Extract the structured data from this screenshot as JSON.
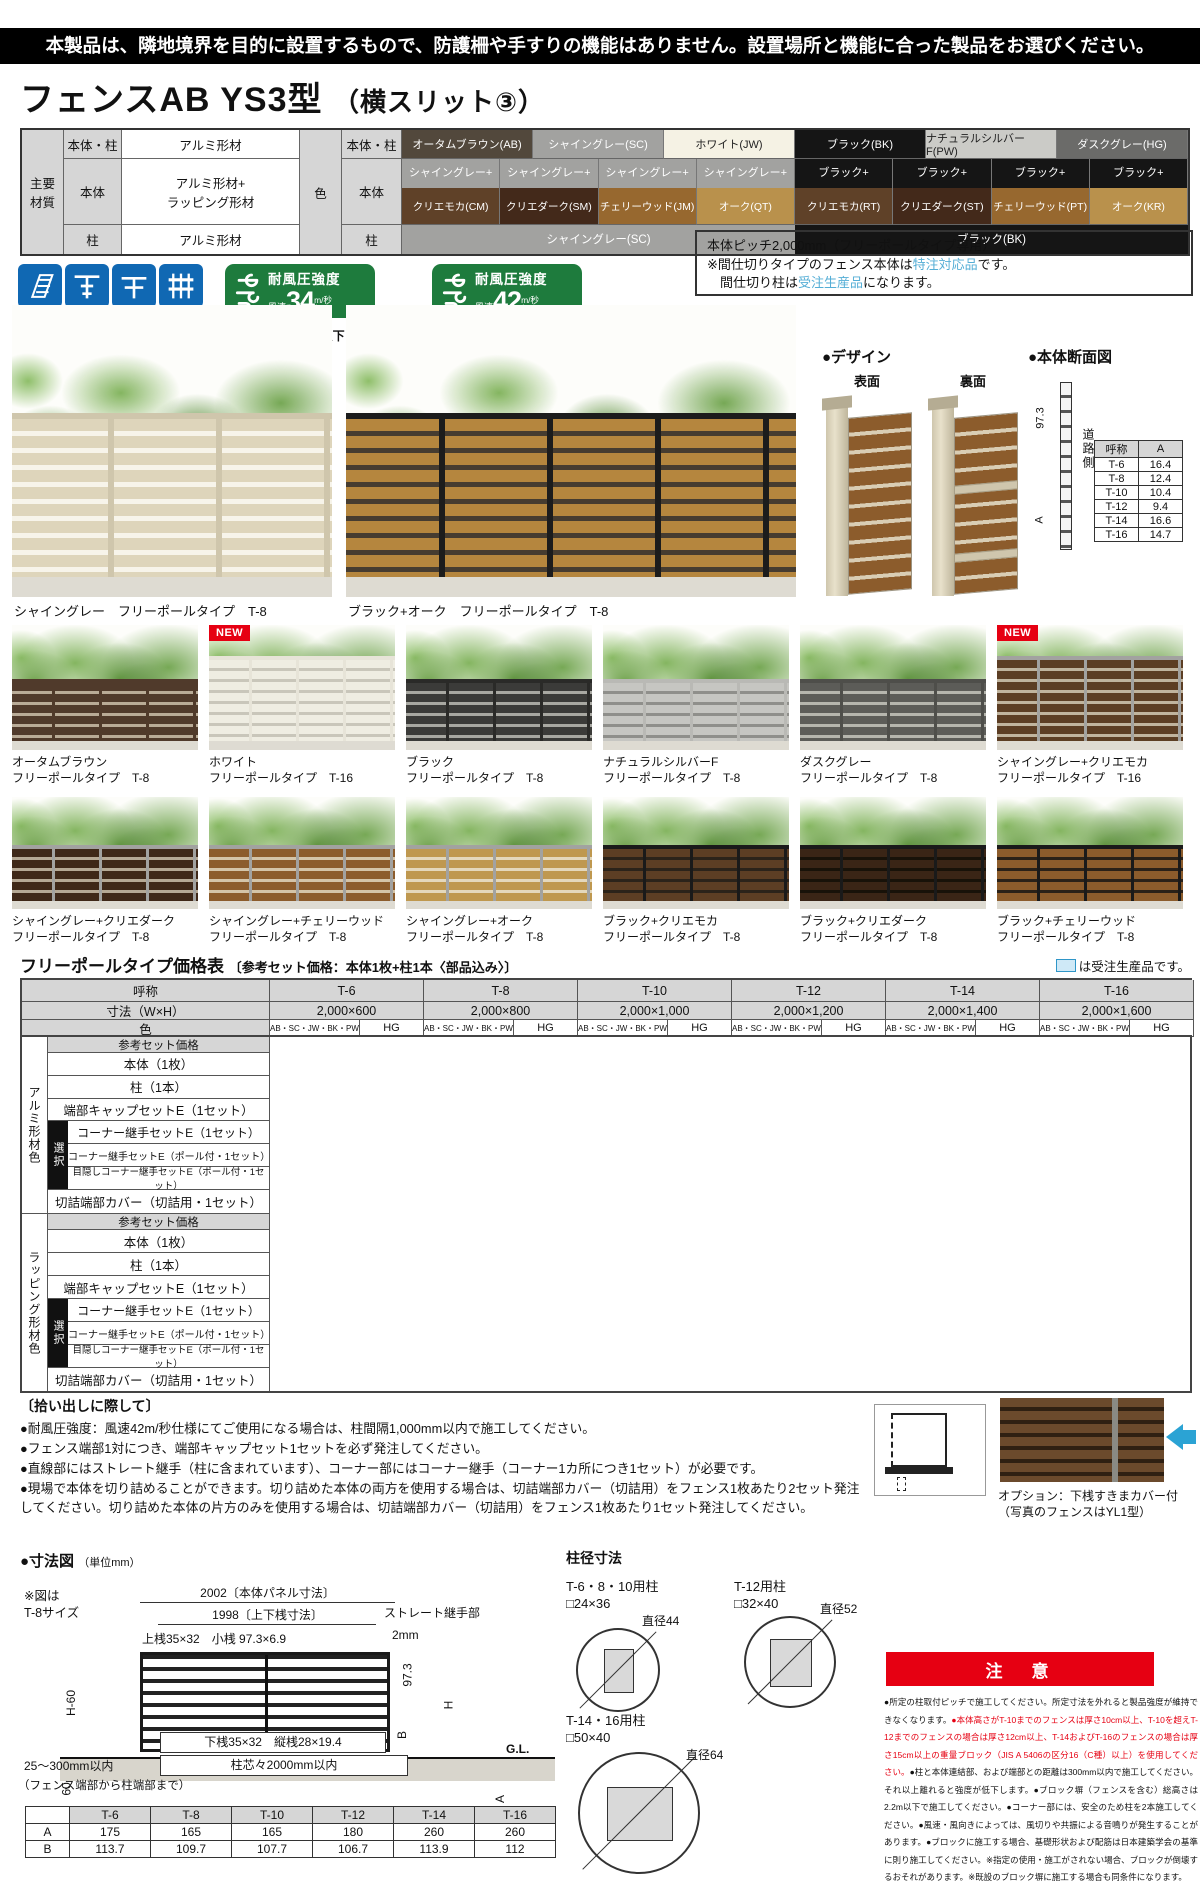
{
  "page": {
    "top_banner": "本製品は、隣地境界を目的に設置するもので、防護柵や手すりの機能はありません。設置場所と機能に合った製品をお選びください。",
    "title_main": "フェンスAB YS3型",
    "title_sub": "（横スリット③）",
    "new_badge": "NEW"
  },
  "materials": {
    "header_main": "主要\n材質",
    "header_color": "色",
    "rows": [
      {
        "part": "本体・柱",
        "material": "アルミ形材"
      },
      {
        "part": "本体",
        "material": "アルミ形材+\nラッピング形材"
      },
      {
        "part": "柱",
        "material": "アルミ形材"
      }
    ],
    "color_parts": [
      "本体・柱",
      "本体",
      "柱"
    ],
    "colors_row1": [
      {
        "label": "オータムブラウン(AB)",
        "bg": "#52483c",
        "fg": "#ffffff"
      },
      {
        "label": "シャイングレー(SC)",
        "bg": "#a2a2a0",
        "fg": "#ffffff"
      },
      {
        "label": "ホワイト(JW)",
        "bg": "#f5f2e4",
        "fg": "#222222"
      },
      {
        "label": "ブラック(BK)",
        "bg": "#151515",
        "fg": "#ffffff"
      },
      {
        "label": "ナチュラルシルバーF(PW)",
        "bg": "#cbcbc7",
        "fg": "#222222"
      },
      {
        "label": "ダスクグレー(HG)",
        "bg": "#6b6b69",
        "fg": "#ffffff"
      }
    ],
    "colors_row2": [
      {
        "top": "シャイングレー+",
        "top_bg": "#a2a2a0",
        "label": "クリエモカ(CM)",
        "bg": "#5f4128"
      },
      {
        "top": "シャイングレー+",
        "top_bg": "#a2a2a0",
        "label": "クリエダーク(SM)",
        "bg": "#43291a"
      },
      {
        "top": "シャイングレー+",
        "top_bg": "#a2a2a0",
        "label": "チェリーウッド(JM)",
        "bg": "#97682f"
      },
      {
        "top": "シャイングレー+",
        "top_bg": "#a2a2a0",
        "label": "オーク(QT)",
        "bg": "#b9914c"
      },
      {
        "top": "ブラック+",
        "top_bg": "#151515",
        "label": "クリエモカ(RT)",
        "bg": "#5f4128"
      },
      {
        "top": "ブラック+",
        "top_bg": "#151515",
        "label": "クリエダーク(ST)",
        "bg": "#43291a"
      },
      {
        "top": "ブラック+",
        "top_bg": "#151515",
        "label": "チェリーウッド(PT)",
        "bg": "#97682f"
      },
      {
        "top": "ブラック+",
        "top_bg": "#151515",
        "label": "オーク(KR)",
        "bg": "#b9914c"
      }
    ],
    "colors_row3": [
      {
        "label": "シャイングレー(SC)",
        "bg": "#a2a2a0",
        "fg": "#ffffff"
      },
      {
        "label": "ブラック(BK)",
        "bg": "#151515",
        "fg": "#ffffff"
      }
    ]
  },
  "features": {
    "icons": [
      {
        "label": "片面模様"
      },
      {
        "label": "フリーポール\n（自在柱）"
      },
      {
        "label": "間仕切り※\n（間柱）"
      },
      {
        "label": "多段取付\n可能"
      }
    ],
    "badges": [
      {
        "title": "耐風圧強度",
        "prefix": "風速",
        "value": "34",
        "unit": "m/秒",
        "suffix": "相当",
        "note": "柱ピッチ2m以下"
      },
      {
        "title": "耐風圧強度",
        "prefix": "風速",
        "value": "42",
        "unit": "m/秒",
        "suffix": "相当",
        "note": "柱ピッチ1m以下"
      }
    ],
    "info_box": {
      "line1": "本体ピッチ2,000mm（フリーポールタイプ専用）",
      "line2_pre": "※間仕切りタイプのフェンス本体は",
      "line2_hl": "特注対応品",
      "line2_post": "です。",
      "line3_pre": "　間仕切り柱は",
      "line3_hl": "受注生産品",
      "line3_post": "になります。"
    }
  },
  "hero": [
    {
      "caption": "シャイングレー　フリーポールタイプ　T-8",
      "slat": "#ded5bb",
      "gap": "#f7f4ea",
      "post": "#cfc6ac",
      "new": false,
      "tall": false
    },
    {
      "caption": "ブラック+オーク　フリーポールタイプ　T-8",
      "slat": "#b5863e",
      "gap": "#463c30",
      "post": "#1c1c1c",
      "new": false,
      "tall": false
    }
  ],
  "design": {
    "heading": "●デザイン",
    "front": "表面",
    "back": "裏面"
  },
  "cross_section": {
    "heading": "●本体断面図",
    "dim": "97.3",
    "dim2": "A",
    "road": "道路側",
    "table_headers": [
      "呼称",
      "A"
    ],
    "table_rows": [
      [
        "T-6",
        "16.4"
      ],
      [
        "T-8",
        "12.4"
      ],
      [
        "T-10",
        "10.4"
      ],
      [
        "T-12",
        "9.4"
      ],
      [
        "T-14",
        "16.6"
      ],
      [
        "T-16",
        "14.7"
      ]
    ]
  },
  "gallery": [
    {
      "name": "オータムブラウン",
      "type": "フリーポールタイプ　T-8",
      "new": false,
      "tall": false,
      "slat": "#503a2b",
      "gap": "#b9ab97",
      "post": "#503a2b"
    },
    {
      "name": "ホワイト",
      "type": "フリーポールタイプ　T-16",
      "new": true,
      "tall": true,
      "slat": "#efede2",
      "gap": "#c9c6ba",
      "post": "#e7e4d8"
    },
    {
      "name": "ブラック",
      "type": "フリーポールタイプ　T-8",
      "new": false,
      "tall": false,
      "slat": "#3b3b39",
      "gap": "#a8a8a2",
      "post": "#2a2a28"
    },
    {
      "name": "ナチュラルシルバーF",
      "type": "フリーポールタイプ　T-8",
      "new": false,
      "tall": false,
      "slat": "#c6c6c2",
      "gap": "#8f8f8b",
      "post": "#b9b9b5"
    },
    {
      "name": "ダスクグレー",
      "type": "フリーポールタイプ　T-8",
      "new": false,
      "tall": false,
      "slat": "#5c5c58",
      "gap": "#b5b5ad",
      "post": "#4e4e4a"
    },
    {
      "name": "シャイングレー+クリエモカ",
      "type": "フリーポールタイプ　T-16",
      "new": true,
      "tall": true,
      "slat": "#5c3e24",
      "gap": "#c0b49e",
      "post": "#a2a2a0"
    },
    {
      "name": "シャイングレー+クリエダーク",
      "type": "フリーポールタイプ　T-8",
      "new": false,
      "tall": false,
      "slat": "#3f2818",
      "gap": "#b5a894",
      "post": "#a2a2a0"
    },
    {
      "name": "シャイングレー+チェリーウッド",
      "type": "フリーポールタイプ　T-8",
      "new": false,
      "tall": false,
      "slat": "#8c5c2c",
      "gap": "#d4c4a8",
      "post": "#a2a2a0"
    },
    {
      "name": "シャイングレー+オーク",
      "type": "フリーポールタイプ　T-8",
      "new": false,
      "tall": false,
      "slat": "#bf984f",
      "gap": "#e4d8bc",
      "post": "#a2a2a0"
    },
    {
      "name": "ブラック+クリエモカ",
      "type": "フリーポールタイプ　T-8",
      "new": false,
      "tall": false,
      "slat": "#5c3e24",
      "gap": "#2b231a",
      "post": "#1a1a1a"
    },
    {
      "name": "ブラック+クリエダーク",
      "type": "フリーポールタイプ　T-8",
      "new": false,
      "tall": false,
      "slat": "#3a2516",
      "gap": "#181209",
      "post": "#1a1a1a"
    },
    {
      "name": "ブラック+チェリーウッド",
      "type": "フリーポールタイプ　T-8",
      "new": false,
      "tall": false,
      "slat": "#8c5c2c",
      "gap": "#2a2118",
      "post": "#1a1a1a"
    }
  ],
  "price_table": {
    "title": "フリーポールタイプ価格表",
    "subtitle": "〔参考セット価格：本体1枚+柱1本〈部品込み〉〕",
    "legend": "は受注生産品です。",
    "name_header": "呼称",
    "columns": [
      "T-6",
      "T-8",
      "T-10",
      "T-12",
      "T-14",
      "T-16"
    ],
    "size_header": "寸法（W×H）",
    "sizes": [
      "2,000×600",
      "2,000×800",
      "2,000×1,000",
      "2,000×1,200",
      "2,000×1,400",
      "2,000×1,600"
    ],
    "color_header": "色",
    "color_groups": [
      "AB・SC・JW・BK・PW",
      "HG"
    ],
    "select_label": "選択",
    "groups": [
      {
        "name": "アルミ形材色"
      },
      {
        "name": "ラッピング形材色"
      }
    ],
    "row_labels": {
      "set": "参考セット価格",
      "rows1": [
        "本体（1枚）",
        "柱（1本）",
        "端部キャップセットE（1セット）"
      ],
      "select_rows": [
        "コーナー継手セットE（1セット）",
        "コーナー継手セットE（ポール付・1セット）",
        "目隠しコーナー継手セットE（ポール付・1セット）"
      ],
      "rows2": [
        "切詰端部カバー（切詰用・1セット）"
      ]
    }
  },
  "notes": {
    "heading": "〔拾い出しに際して〕",
    "items": [
      "●耐風圧強度：風速42m/秒仕様にてご使用になる場合は、柱間隔1,000mm以内で施工してください。",
      "●フェンス端部1対につき、端部キャップセット1セットを必ず発注してください。",
      "●直線部にはストレート継手（柱に含まれています）、コーナー部にはコーナー継手（コーナー1カ所につき1セット）が必要です。",
      "●現場で本体を切り詰めることができます。切り詰めた本体の両方を使用する場合は、切詰端部カバー（切詰用）をフェンス1枚あたり2セット発注してください。切り詰めた本体の片方のみを使用する場合は、切詰端部カバー（切詰用）をフェンス1枚あたり1セット発注してください。"
    ],
    "option_caption1": "オプション：下桟すきまカバー付",
    "option_caption2": "（写真のフェンスはYL1型）"
  },
  "dimensions": {
    "heading": "●寸法図",
    "unit": "（単位mm）",
    "fig_note": "※図は\nT-8サイズ",
    "panel_width": "2002〔本体パネル寸法〕",
    "rail_width": "1998〔上下桟寸法〕",
    "joint_label": "ストレート継手部",
    "joint_size": "2mm",
    "top_rail": "上桟35×32　小桟 97.3×6.9",
    "h60": "H-60",
    "v973": "97.3",
    "h": "H",
    "b": "B",
    "gl": "G.L.",
    "v60": "60",
    "a": "A",
    "bottom_rail": "下桟35×32　縦桟28×19.4",
    "pitch": "柱芯々2000mm以内",
    "end_range": "25～300mm以内",
    "end_note": "（フェンス端部から柱端部まで）",
    "ab_table": {
      "cols": [
        "T-6",
        "T-8",
        "T-10",
        "T-12",
        "T-14",
        "T-16"
      ],
      "rows": [
        {
          "label": "A",
          "values": [
            "175",
            "165",
            "165",
            "180",
            "260",
            "260"
          ]
        },
        {
          "label": "B",
          "values": [
            "113.7",
            "109.7",
            "107.7",
            "106.7",
            "113.9",
            "112"
          ]
        }
      ]
    }
  },
  "post_sizes": {
    "heading": "柱径寸法",
    "items": [
      {
        "label": "T-6・8・10用柱",
        "size": "□24×36",
        "dia": "直径44"
      },
      {
        "label": "T-12用柱",
        "size": "□32×40",
        "dia": "直径52"
      },
      {
        "label": "T-14・16用柱",
        "size": "□50×40",
        "dia": "直径64"
      }
    ]
  },
  "caution": {
    "banner": "注　意",
    "segments": [
      {
        "color": "#111111",
        "text": "●所定の柱取付ピッチで施工してください。所定寸法を外れると製品強度が維持できなくなります。"
      },
      {
        "color": "#e60012",
        "text": "●本体高さがT-10までのフェンスは厚さ10cm以上、T-10を超えT-12までのフェンスの場合は厚さ12cm以上、T-14およびT-16のフェンスの場合は厚さ15cm以上の重量ブロック（JIS A 5406の区分16（C種）以上）を使用してください。"
      },
      {
        "color": "#111111",
        "text": "●柱と本体連結部、および端部との距離は300mm以内で施工してください。それ以上離れると強度が低下します。●ブロック塀（フェンスを含む）総高さは2.2m以下で施工してください。●コーナー部には、安全のため柱を2本施工してください。●風速・風向きによっては、風切りや共振による音鳴りが発生することがあります。●ブロックに施工する場合、基礎形状および配筋は日本建築学会の基準に則り施工してください。※指定の使用・施工がされない場合、ブロックが倒壊するおそれがあります。※既設のブロック塀に施工する場合も同条件になります。"
      }
    ]
  }
}
